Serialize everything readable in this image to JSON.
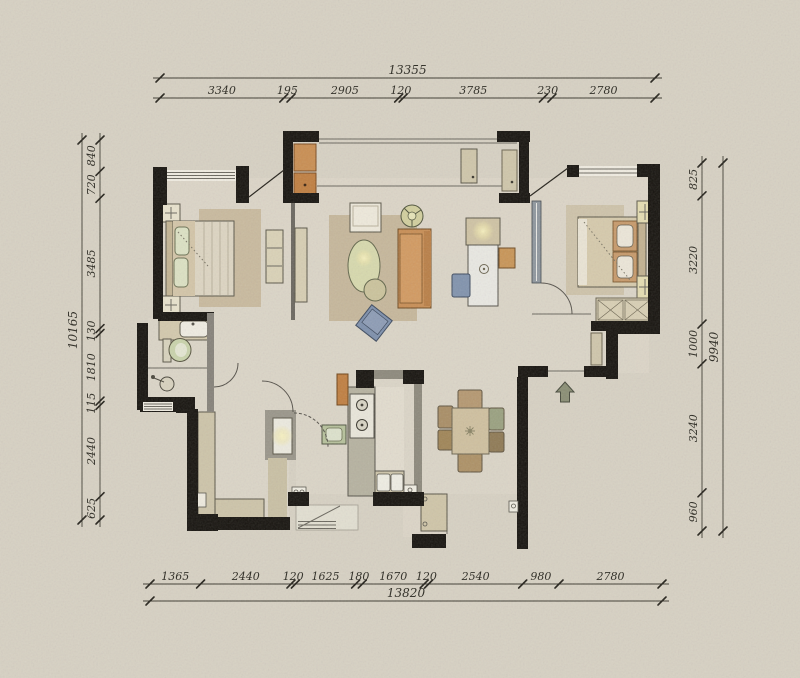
{
  "drawing": {
    "type": "apartment floor plan",
    "units": "mm"
  },
  "dimensions": {
    "top": {
      "total": "13355",
      "segments": [
        "3340",
        "195",
        "2905",
        "120",
        "3785",
        "230",
        "2780"
      ]
    },
    "bottom": {
      "total": "13820",
      "segments": [
        "1365",
        "2440",
        "120",
        "1625",
        "180",
        "1670",
        "120",
        "2540",
        "980",
        "2780"
      ]
    },
    "left": {
      "total": "10165",
      "segments": [
        "840",
        "720",
        "3485",
        "130",
        "1810",
        "115",
        "2440",
        "625"
      ]
    },
    "right": {
      "total": "9940",
      "segments": [
        "825",
        "3220",
        "1000",
        "3240",
        "960"
      ]
    }
  },
  "icons": {
    "entry_arrow": "entry-direction-arrow"
  },
  "palette": {
    "paper": "#d7d1c3",
    "wall": "#17140f",
    "floor": "#e0d9cb",
    "rug": "#c6b79b",
    "sofa_orange": "#c88e55",
    "cabinet_orange": "#c07f41",
    "upholstery_blue": "#7e90ac",
    "plant_green": "#c9d3ab",
    "counter_tan": "#cdc4a9",
    "kitchen_grey": "#b6b2a0",
    "lamp_glow": "#f8f2c0",
    "dimension_text": "#2a2820"
  }
}
